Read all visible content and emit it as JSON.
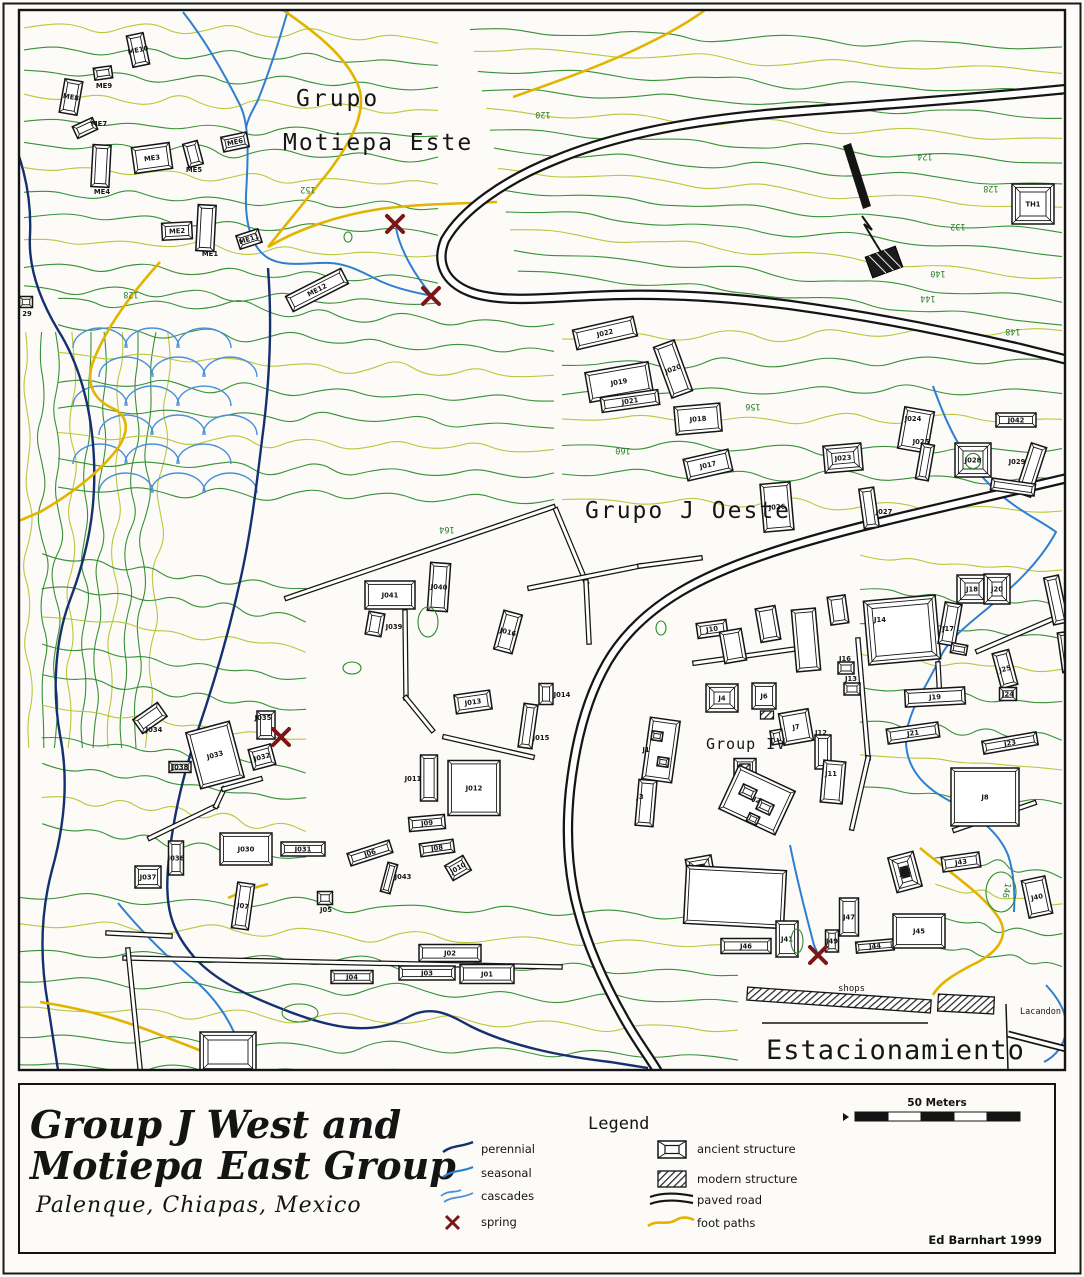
{
  "title": {
    "line1": "Group J West and",
    "line2": "Motiepa East Group",
    "subtitle": "Palenque, Chiapas, Mexico"
  },
  "credit": "Ed Barnhart 1999",
  "legend": {
    "title": "Legend",
    "water": [
      {
        "label": "perennial"
      },
      {
        "label": "seasonal"
      },
      {
        "label": "cascades"
      },
      {
        "label": "spring"
      }
    ],
    "features": [
      {
        "label": "ancient structure"
      },
      {
        "label": "modern structure"
      },
      {
        "label": "paved road"
      },
      {
        "label": "foot paths"
      }
    ]
  },
  "scale": {
    "label": "50 Meters"
  },
  "colors": {
    "perennial": "#14306e",
    "seasonal": "#2f7fd1",
    "cascades": "#4a90d9",
    "spring": "#7a1518",
    "footpath": "#e2b400",
    "contour_green": "#2d8a2d",
    "contour_yellow": "#b6c432",
    "ink": "#151515"
  },
  "map": {
    "regions": [
      {
        "t": "Grupo",
        "x": 296,
        "y": 106,
        "s": 23,
        "ls": 3
      },
      {
        "t": "Motiepa Este",
        "x": 283,
        "y": 150,
        "s": 23,
        "ls": 2
      },
      {
        "t": "Grupo J Oeste",
        "x": 585,
        "y": 518,
        "s": 23,
        "ls": 2
      },
      {
        "t": "Group IV",
        "x": 706,
        "y": 749,
        "s": 15,
        "ls": 1
      },
      {
        "t": "Estacionamiento",
        "x": 766,
        "y": 1059,
        "s": 27,
        "ls": 1
      },
      {
        "t": "shops",
        "x": 838,
        "y": 991,
        "s": 9,
        "ls": 0
      },
      {
        "t": "Lacandon sh",
        "x": 1020,
        "y": 1014,
        "s": 8.5,
        "ls": 0
      }
    ],
    "contour_labels": [
      {
        "t": "124",
        "x": 925,
        "y": 154,
        "r": 180
      },
      {
        "t": "128",
        "x": 991,
        "y": 186,
        "r": 180
      },
      {
        "t": "132",
        "x": 958,
        "y": 224,
        "r": 180
      },
      {
        "t": "140",
        "x": 938,
        "y": 271,
        "r": 180
      },
      {
        "t": "144",
        "x": 928,
        "y": 296,
        "r": 180
      },
      {
        "t": "148",
        "x": 1013,
        "y": 329,
        "r": 180
      },
      {
        "t": "120",
        "x": 543,
        "y": 112,
        "r": 180
      },
      {
        "t": "152",
        "x": 308,
        "y": 187,
        "r": 180
      },
      {
        "t": "156",
        "x": 753,
        "y": 404,
        "r": 180
      },
      {
        "t": "160",
        "x": 623,
        "y": 448,
        "r": 180
      },
      {
        "t": "164",
        "x": 447,
        "y": 527,
        "r": 180
      },
      {
        "t": "128",
        "x": 131,
        "y": 292,
        "r": 180
      },
      {
        "t": "146",
        "x": 1004,
        "y": 890,
        "r": 100
      }
    ],
    "springs": [
      [
        395,
        224
      ],
      [
        431,
        296
      ],
      [
        281,
        737
      ],
      [
        818,
        955
      ]
    ],
    "structures": [
      [
        "ME10",
        138,
        50,
        17,
        32,
        -12
      ],
      [
        "ME9",
        103,
        73,
        18,
        12,
        -8,
        "p",
        104,
        88
      ],
      [
        "ME8",
        71,
        97,
        18,
        34,
        10
      ],
      [
        "ME7",
        85,
        128,
        22,
        13,
        -25,
        "p",
        99,
        126
      ],
      [
        "ME3",
        152,
        158,
        38,
        26,
        -8
      ],
      [
        "ME5",
        193,
        154,
        15,
        24,
        -15,
        "p",
        194,
        172
      ],
      [
        "ME6",
        235,
        142,
        26,
        15,
        -12
      ],
      [
        "ME4",
        101,
        166,
        18,
        42,
        3,
        "p",
        102,
        194
      ],
      [
        "ME2",
        177,
        231,
        30,
        17,
        -3
      ],
      [
        "ME1",
        206,
        228,
        18,
        46,
        3,
        "p",
        210,
        256
      ],
      [
        "ME11",
        249,
        239,
        23,
        14,
        -18
      ],
      [
        "ME12",
        317,
        290,
        62,
        17,
        -27
      ],
      [
        "29",
        26,
        302,
        13,
        11,
        0,
        "p",
        27,
        316
      ],
      [
        "TH1",
        1033,
        204,
        42,
        40,
        0,
        "y"
      ],
      [
        "J022",
        605,
        333,
        62,
        20,
        -13
      ],
      [
        "J020",
        673,
        369,
        22,
        54,
        -20
      ],
      [
        "J019",
        619,
        382,
        64,
        30,
        -10
      ],
      [
        "J021",
        630,
        401,
        58,
        15,
        -8
      ],
      [
        "J018",
        698,
        419,
        46,
        28,
        -5
      ],
      [
        "J017",
        708,
        465,
        46,
        22,
        -13
      ],
      [
        "J026",
        777,
        507,
        30,
        48,
        -5
      ],
      [
        "J023",
        843,
        458,
        38,
        27,
        -5,
        "y"
      ],
      [
        "J027",
        869,
        508,
        15,
        40,
        -8,
        "p",
        884,
        514
      ],
      [
        "J024",
        916,
        430,
        30,
        42,
        10,
        "p",
        913,
        421
      ],
      [
        "J025",
        925,
        462,
        13,
        36,
        10,
        "p",
        921,
        444
      ],
      [
        "J042",
        1016,
        420,
        40,
        14,
        0
      ],
      [
        "J028",
        973,
        460,
        36,
        34,
        0,
        "yc"
      ],
      [
        "J029",
        1031,
        470,
        16,
        52,
        18,
        "p",
        1017,
        464
      ],
      [
        "",
        1013,
        487,
        44,
        12,
        8
      ],
      [
        "J041",
        390,
        595,
        50,
        28,
        0
      ],
      [
        "J040",
        439,
        587,
        20,
        48,
        4
      ],
      [
        "J039",
        375,
        624,
        16,
        23,
        10,
        "p",
        394,
        629
      ],
      [
        "J016",
        508,
        632,
        19,
        40,
        15
      ],
      [
        "J013",
        473,
        702,
        36,
        19,
        -8
      ],
      [
        "J014",
        546,
        694,
        14,
        21,
        0,
        "p",
        562,
        697
      ],
      [
        "J015",
        528,
        726,
        14,
        44,
        8,
        "p",
        541,
        740
      ],
      [
        "J011",
        429,
        778,
        17,
        46,
        0,
        "p",
        413,
        781
      ],
      [
        "J012",
        474,
        788,
        52,
        55,
        0
      ],
      [
        "J010",
        458,
        868,
        21,
        17,
        -30
      ],
      [
        "J08",
        437,
        848,
        34,
        13,
        -8
      ],
      [
        "J09",
        427,
        823,
        36,
        14,
        -5
      ],
      [
        "J034",
        150,
        718,
        30,
        17,
        -35,
        "p",
        154,
        732
      ],
      [
        "J033",
        215,
        755,
        45,
        58,
        -15
      ],
      [
        "J038",
        180,
        767,
        22,
        11,
        0
      ],
      [
        "J032",
        262,
        757,
        23,
        21,
        -15
      ],
      [
        "J035",
        266,
        725,
        18,
        28,
        0,
        "p",
        263,
        720
      ],
      [
        "J030",
        246,
        849,
        52,
        32,
        0
      ],
      [
        "J036",
        176,
        858,
        15,
        34,
        0
      ],
      [
        "J037",
        148,
        877,
        26,
        22,
        0
      ],
      [
        "J031",
        303,
        849,
        44,
        14,
        0
      ],
      [
        "J07",
        243,
        906,
        17,
        46,
        8
      ],
      [
        "J05",
        325,
        898,
        15,
        13,
        0,
        "p",
        326,
        912
      ],
      [
        "J06",
        370,
        853,
        44,
        13,
        -18
      ],
      [
        "J043",
        389,
        878,
        10,
        30,
        15,
        "p",
        403,
        879
      ],
      [
        "J02",
        450,
        953,
        62,
        17,
        0
      ],
      [
        "J03",
        427,
        973,
        56,
        14,
        0
      ],
      [
        "J01",
        487,
        974,
        54,
        19,
        0
      ],
      [
        "J04",
        352,
        977,
        42,
        13,
        0
      ],
      [
        "",
        228,
        1052,
        56,
        40,
        0,
        "y"
      ],
      [
        "J1",
        661,
        750,
        30,
        62,
        8,
        "p",
        646,
        752
      ],
      [
        "",
        657,
        736,
        11,
        9,
        8
      ],
      [
        "",
        663,
        762,
        11,
        9,
        8
      ],
      [
        "J10",
        712,
        629,
        30,
        15,
        -8
      ],
      [
        "",
        733,
        646,
        22,
        32,
        -10
      ],
      [
        "J4",
        722,
        698,
        32,
        28,
        0,
        "y"
      ],
      [
        "J6",
        764,
        696,
        24,
        26,
        0
      ],
      [
        "",
        767,
        715,
        13,
        8,
        0,
        "m"
      ],
      [
        "J5",
        745,
        767,
        22,
        17,
        0
      ],
      [
        "",
        745,
        768,
        10,
        8,
        0,
        "m"
      ],
      [
        "J7",
        796,
        727,
        30,
        32,
        -10
      ],
      [
        "",
        777,
        737,
        12,
        14,
        -10
      ],
      [
        "J12",
        823,
        752,
        16,
        34,
        0,
        "p",
        821,
        735
      ],
      [
        "J16",
        846,
        668,
        16,
        12,
        0,
        "p",
        845,
        661
      ],
      [
        "J13",
        852,
        689,
        16,
        12,
        0,
        "p",
        851,
        681
      ],
      [
        "J14",
        902,
        630,
        72,
        64,
        -5,
        "y",
        880,
        622
      ],
      [
        "J17",
        950,
        624,
        17,
        42,
        10,
        "p",
        948,
        631
      ],
      [
        "",
        959,
        649,
        16,
        10,
        10
      ],
      [
        "J18",
        972,
        589,
        30,
        28,
        0,
        "y"
      ],
      [
        "J20",
        997,
        589,
        26,
        30,
        0,
        "y"
      ],
      [
        "J25",
        1005,
        669,
        17,
        36,
        -15
      ],
      [
        "J24",
        1008,
        694,
        17,
        13,
        0
      ],
      [
        "J19",
        935,
        697,
        60,
        17,
        -3
      ],
      [
        "J21",
        913,
        733,
        52,
        15,
        -8
      ],
      [
        "J23",
        1010,
        743,
        55,
        13,
        -10
      ],
      [
        "J8",
        985,
        797,
        68,
        58,
        0
      ],
      [
        "J11",
        833,
        782,
        22,
        42,
        5,
        "p",
        831,
        776
      ],
      [
        "J3",
        646,
        803,
        18,
        46,
        5,
        "p",
        640,
        799
      ],
      [
        "J2",
        757,
        800,
        62,
        48,
        25
      ],
      [
        "",
        748,
        792,
        15,
        11,
        25
      ],
      [
        "",
        765,
        807,
        15,
        11,
        25
      ],
      [
        "",
        753,
        819,
        11,
        9,
        25
      ],
      [
        "",
        700,
        868,
        26,
        22,
        -10,
        "yd"
      ],
      [
        "J42",
        905,
        872,
        26,
        36,
        -15,
        "yd"
      ],
      [
        "J43",
        961,
        862,
        38,
        15,
        -8
      ],
      [
        "J40",
        1037,
        897,
        24,
        38,
        -12
      ],
      [
        "",
        735,
        897,
        100,
        58,
        3
      ],
      [
        "J46",
        746,
        946,
        50,
        15,
        0
      ],
      [
        "J41",
        787,
        939,
        22,
        36,
        0
      ],
      [
        "J47",
        849,
        917,
        19,
        38,
        0
      ],
      [
        "J49",
        832,
        941,
        13,
        22,
        0
      ],
      [
        "J44",
        875,
        946,
        38,
        11,
        -5
      ],
      [
        "J45",
        919,
        931,
        52,
        34,
        0
      ],
      [
        "",
        1056,
        600,
        15,
        48,
        -12
      ],
      [
        "",
        1066,
        652,
        12,
        40,
        -8
      ],
      [
        "",
        806,
        640,
        24,
        62,
        -5
      ],
      [
        "",
        768,
        624,
        20,
        34,
        -10
      ],
      [
        "",
        838,
        610,
        18,
        28,
        -8
      ],
      [
        "",
        839,
        1000,
        184,
        13,
        4,
        "m"
      ],
      [
        "",
        966,
        1004,
        56,
        17,
        3,
        "m"
      ]
    ]
  }
}
